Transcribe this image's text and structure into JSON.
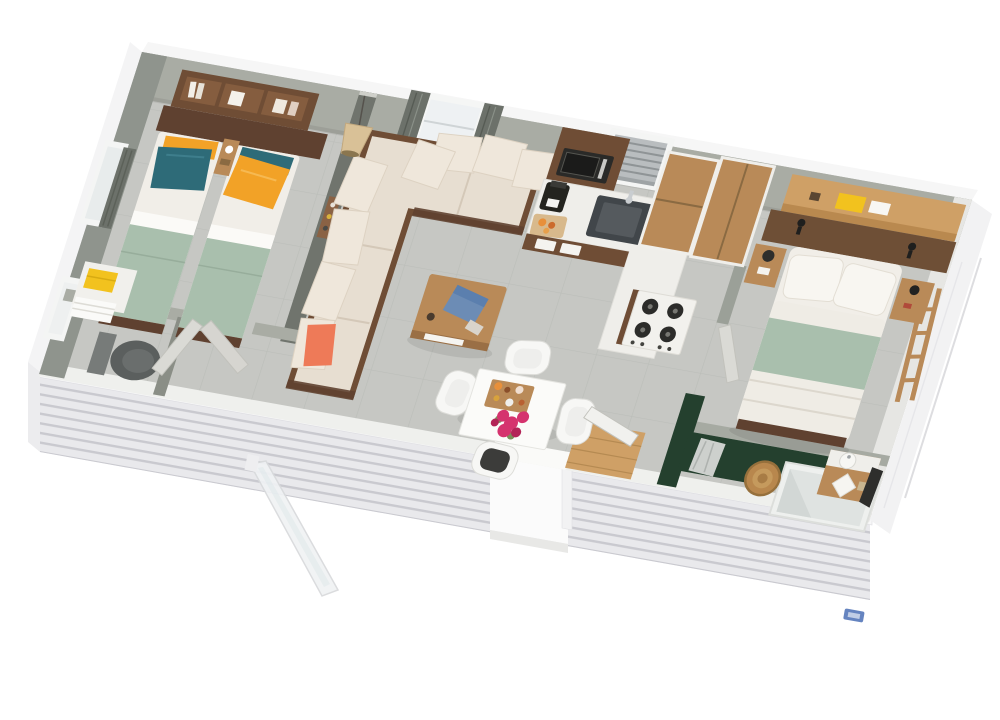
{
  "meta": {
    "type": "3d-floor-plan-rendering",
    "subject": "Isometric 3D floor plan of a mobile home / holiday chalet with two twin-bed bedroom, WC, living room, kitchen, master bedroom and bathroom",
    "view": "top-down isometric, rotated clockwise ~10 degrees"
  },
  "colors": {
    "background": "#ffffff",
    "floor": "#c6c7c3",
    "floorline": "#b3b5b1",
    "wallface": "#a9aca4",
    "wallfacedark": "#8f948d",
    "walldivider": "#70746d",
    "siding": "#e9e9ec",
    "sidingline": "#c9c9cf",
    "sidingtrim": "#f7f7f8",
    "wooddark": "#6f4d35",
    "woodmid": "#b98a58",
    "woodlight": "#cfa066",
    "sofa": "#e7ded1",
    "sofashadow": "#d4c8b8",
    "cushion": "#efe7db",
    "mattress": "#f1eee8",
    "sage": "#a9bfad",
    "teal": "#2e6b78",
    "orange": "#f2a227",
    "coral": "#ee7a58",
    "yellow": "#f2c21e",
    "greenwall": "#24402e",
    "counter": "#efeeea",
    "sink": "#41464a",
    "appliance": "#2a2a28",
    "blind": "#b9bdbf",
    "curtain": "#6c716a",
    "flower": "#d5336e",
    "laptop": "#5b7fae",
    "rattan": "#d9c197",
    "toilet": "#5b5f5e",
    "basket": "#b8874d",
    "doorleaf": "#dadad5",
    "glass": "#eef1f3",
    "logo": "#4a6fb5"
  },
  "rooms": [
    {
      "id": "twin-bedroom",
      "label": "Twin bedroom",
      "items": [
        "wall shelf with books",
        "twin bed with teal pillow and orange bolster",
        "twin bed with orange pillow and teal bolster",
        "nightstand",
        "window with dark curtain"
      ]
    },
    {
      "id": "wc",
      "label": "WC",
      "items": [
        "toilet",
        "shelf with yellow towel and white towels",
        "frosted window",
        "toilet paper holder"
      ]
    },
    {
      "id": "living-room",
      "label": "Living room",
      "items": [
        "L-shaped beige corner sofa",
        "coral accent cushion",
        "rattan pendant lamp",
        "window with grey curtains",
        "wood coffee table with blue laptop",
        "white dining table with flowers and food tray",
        "four white shell chairs"
      ]
    },
    {
      "id": "kitchen",
      "label": "Kitchen",
      "items": [
        "wood upper cabinet with microwave",
        "window with venetian blind",
        "white counter with dark sink",
        "coffee maker",
        "cutting board with food",
        "tall wood cabinet",
        "gas hob with four burners"
      ]
    },
    {
      "id": "master-bedroom",
      "label": "Master bedroom",
      "items": [
        "wardrobe",
        "oak shelf with yellow box",
        "dark wood headboard with black wall lamps",
        "double bed with sage throw",
        "two nightstands",
        "decorative wood ladder"
      ]
    },
    {
      "id": "bathroom",
      "label": "Bathroom",
      "items": [
        "dark green feature wall",
        "hanging grey towel",
        "wood vanity with washbasin and towels",
        "white shower enclosure",
        "round woven basket",
        "hanging dark clothes"
      ]
    },
    {
      "id": "exterior",
      "label": "Exterior",
      "items": [
        "white clapboard siding",
        "terrace doorway opening",
        "open glass entry door",
        "small blue brand mark"
      ]
    }
  ]
}
